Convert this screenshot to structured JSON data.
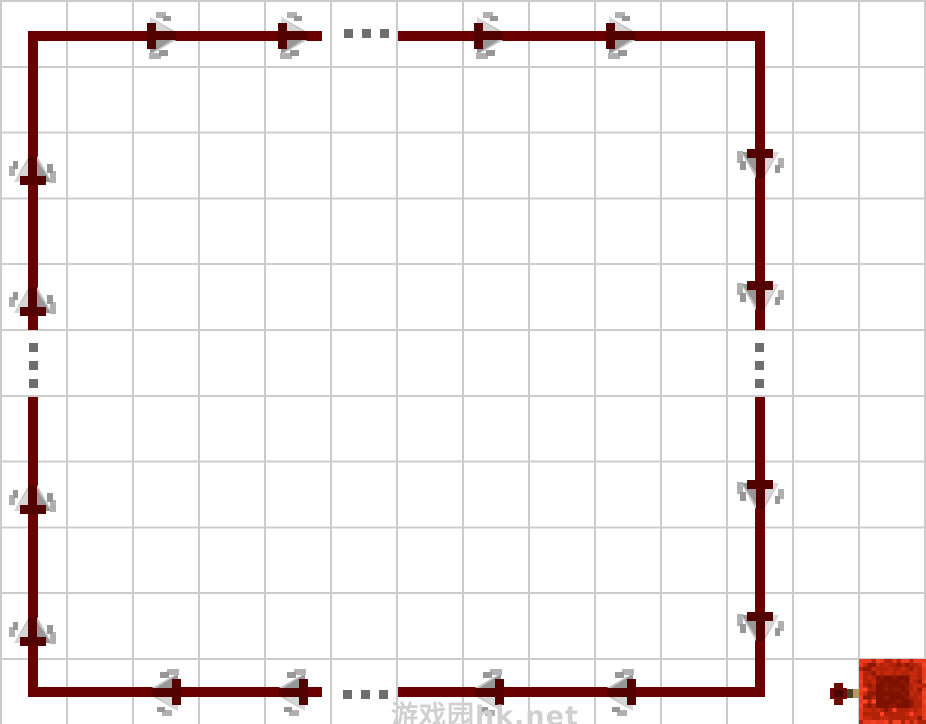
{
  "diagram": {
    "type": "redstone-circuit-loop",
    "canvas": {
      "width": 926,
      "height": 724,
      "bg": "#ffffff"
    },
    "grid": {
      "cols": 14,
      "rows": 11,
      "cell_w": 66,
      "cell_h": 65.8,
      "line_color": "#cccccc",
      "line_px": 2
    },
    "colors": {
      "wire": "#6a0000",
      "arrow_gray": "#c3c3c3",
      "arrow_gray_light": "#d6d6d6",
      "arrow_gray_mid": "#b0b0b0",
      "arrow_gray_dark": "#979797",
      "arrow_maroon": "#520000",
      "dot": "#6e6e6e",
      "torch_head": "#6d0b04",
      "torch_head_dark": "#4a0602",
      "torch_stick": "#b59a63",
      "torch_stick_dark": "#4a4426",
      "block_border": "#e8391d",
      "block_border2": "#f04424",
      "block_mid": "#b22208",
      "block_mid2": "#c62a0c",
      "block_dark": "#7c1100",
      "block_dark2": "#8e1804",
      "block_spark": "#ff4526",
      "watermark": "#d0d0d0"
    },
    "wire_thickness": 10,
    "wires": [
      {
        "name": "top-left",
        "x": 28,
        "y": 31,
        "w": 294,
        "h": 10
      },
      {
        "name": "top-right",
        "x": 398,
        "y": 31,
        "w": 367,
        "h": 10
      },
      {
        "name": "left-upper",
        "x": 28,
        "y": 31,
        "w": 10,
        "h": 299
      },
      {
        "name": "left-lower",
        "x": 28,
        "y": 397,
        "w": 10,
        "h": 300
      },
      {
        "name": "right-upper",
        "x": 755,
        "y": 31,
        "w": 10,
        "h": 299
      },
      {
        "name": "right-lower",
        "x": 755,
        "y": 397,
        "w": 10,
        "h": 300
      },
      {
        "name": "bottom-left",
        "x": 28,
        "y": 687,
        "w": 294,
        "h": 10
      },
      {
        "name": "bottom-right",
        "x": 398,
        "y": 687,
        "w": 367,
        "h": 10
      }
    ],
    "arrows": [
      {
        "dir": "right",
        "cx": 162,
        "cy": 36
      },
      {
        "dir": "right",
        "cx": 293,
        "cy": 36
      },
      {
        "dir": "right",
        "cx": 489,
        "cy": 36
      },
      {
        "dir": "right",
        "cx": 621,
        "cy": 36
      },
      {
        "dir": "down",
        "cx": 760,
        "cy": 164
      },
      {
        "dir": "down",
        "cx": 760,
        "cy": 296
      },
      {
        "dir": "down",
        "cx": 760,
        "cy": 495
      },
      {
        "dir": "down",
        "cx": 760,
        "cy": 627
      },
      {
        "dir": "up",
        "cx": 33,
        "cy": 170
      },
      {
        "dir": "up",
        "cx": 33,
        "cy": 301
      },
      {
        "dir": "up",
        "cx": 33,
        "cy": 499
      },
      {
        "dir": "up",
        "cx": 33,
        "cy": 631
      },
      {
        "dir": "left",
        "cx": 166,
        "cy": 692
      },
      {
        "dir": "left",
        "cx": 293,
        "cy": 692
      },
      {
        "dir": "left",
        "cx": 489,
        "cy": 692
      },
      {
        "dir": "left",
        "cx": 621,
        "cy": 692
      }
    ],
    "ellipsis_dots": {
      "size": 9,
      "positions": [
        [
          344,
          29
        ],
        [
          362,
          29
        ],
        [
          380,
          29
        ],
        [
          343,
          690
        ],
        [
          361,
          690
        ],
        [
          379,
          690
        ],
        [
          29,
          343
        ],
        [
          29,
          361
        ],
        [
          29,
          379
        ],
        [
          755,
          343
        ],
        [
          755,
          361
        ],
        [
          755,
          379
        ]
      ]
    },
    "torch": {
      "x": 826,
      "y": 681,
      "w": 36,
      "h": 26
    },
    "block": {
      "x": 859,
      "y": 659,
      "w": 67,
      "h": 65
    },
    "watermark": {
      "text": "游戏园hk.net",
      "x": 391,
      "y": 694,
      "font_px": 27
    }
  }
}
